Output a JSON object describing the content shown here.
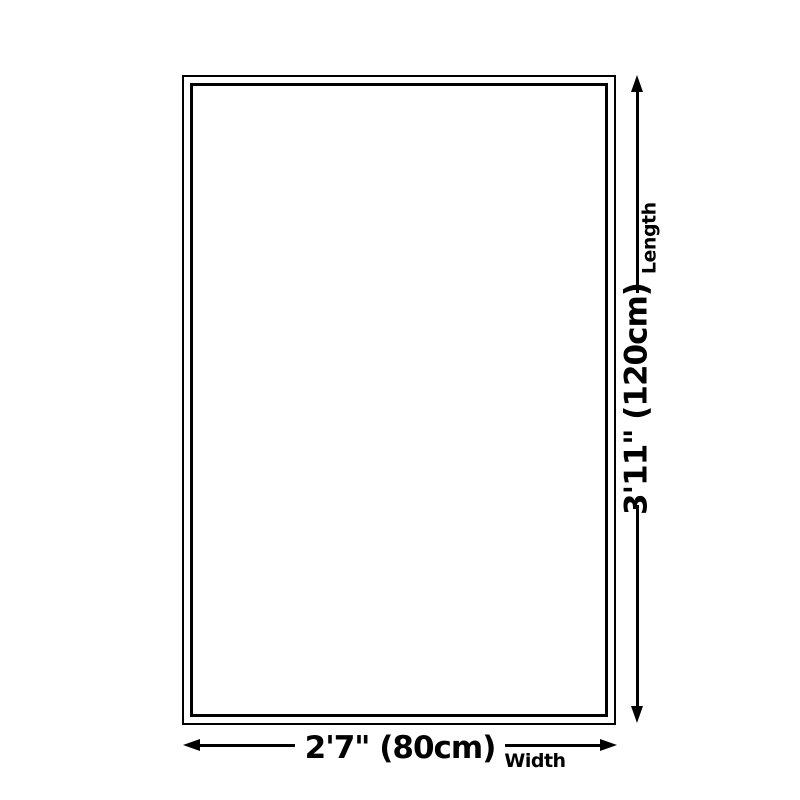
{
  "diagram": {
    "type": "product-dimension-diagram",
    "colors": {
      "line": "#000000",
      "background": "#ffffff"
    },
    "length": {
      "value": "3'11\" (120cm)",
      "axis_label": "Length"
    },
    "width": {
      "value": "2'7\" (80cm)",
      "axis_label": "Width"
    }
  }
}
